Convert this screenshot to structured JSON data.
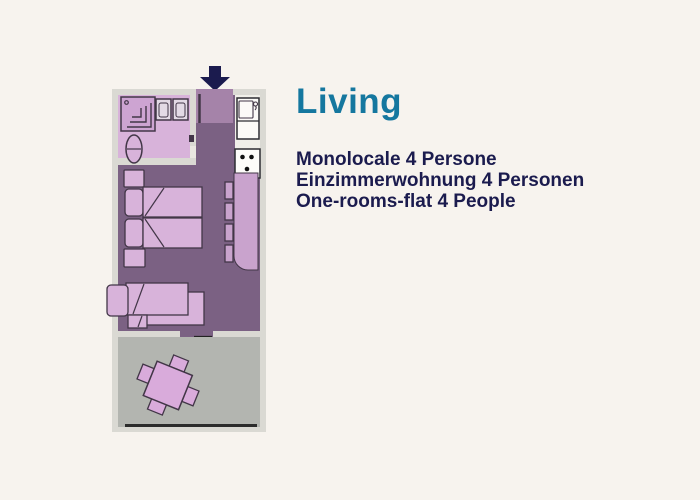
{
  "title": {
    "text": "Living"
  },
  "description": {
    "lines": [
      "Monolocale 4 Persone",
      "Einzimmerwohnung 4 Personen",
      "One-rooms-flat 4 People"
    ]
  },
  "floorplan": {
    "icons": [
      "entrance-arrow-icon",
      "entry-door-icon",
      "shower-icon",
      "toilet-icon",
      "bathroom-sink-icon",
      "kitchen-sink-icon",
      "stove-icon",
      "kitchen-counter-icon",
      "double-bed-icon",
      "sofa-bed-icon",
      "terrace-door-icon",
      "dining-table-icon"
    ]
  },
  "colors": {
    "bg": "#f7f3ee",
    "wall": "#dad9d3",
    "floor_purple": "#7b6183",
    "entry_mauve": "#a583a9",
    "pink_light": "#d8b3da",
    "pink_mid": "#cda4d2",
    "counter_purple": "#c9a3cd",
    "white_area": "#f0efe9",
    "terrace_gray": "#b3b5b0",
    "table_pink": "#d9abdb",
    "arrow_navy": "#1b1b4e",
    "title_teal": "#15779f",
    "text_navy": "#1b1b4e",
    "outline": "#423647"
  }
}
